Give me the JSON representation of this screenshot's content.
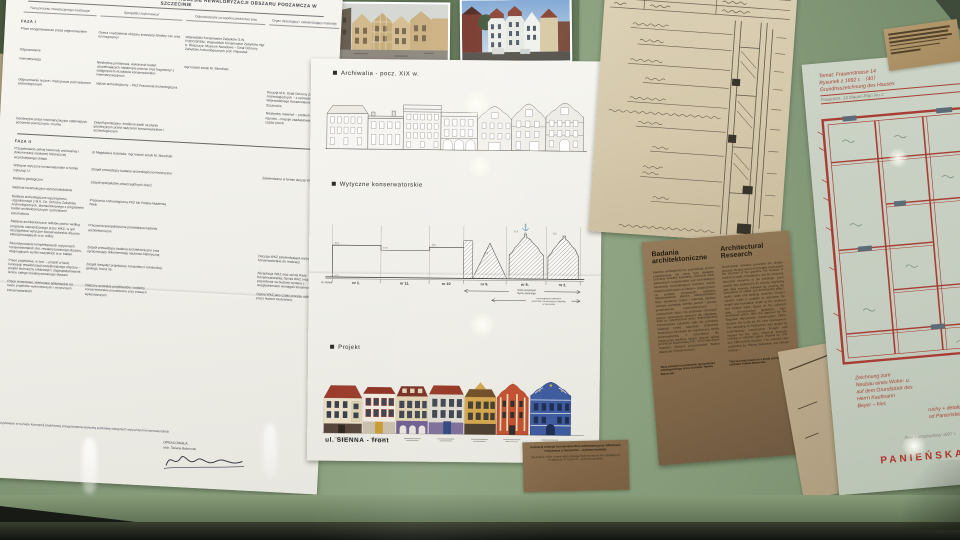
{
  "left_doc": {
    "title": "SCHEMAT POSTĘPOWANIA KONSERWATORSKIEGO W PROCESIE REWALORYZACJI OBSZARU PODZAMCZA W SZCZECINIE",
    "columns": [
      "Faza procesu inwestycyjnego /realizacja/",
      "Specjaliści /wykonawcy/",
      "Odpowiedzialni za współuczestnictwo prac",
      "Organ decydujący i zatwierdzający materiały"
    ],
    "faza1_label": "FAZA I",
    "faza2_label": "FAZA II",
    "faza1_rows": [
      {
        "c1": "Prace przygotowawcze przed odgruzowaniem",
        "c2": "Ocena i wydzielenie obszaru inwestycji /obiekty ruin oraz ich fragmenty/",
        "c3": "Wojewódzki Konserwator Zabytków O.W. PODGÓRSKI; Wojewódzki Konserwator Zabytków mgr K. Błaszczyk; Muzeum Narodowe – Dział Ochrony Zabytków Archeologicznych prof. Filipowiak",
        "c4": ""
      },
      {
        "c1": "Odgruzowanie",
        "c2": "",
        "c3": "",
        "c4": ""
      },
      {
        "c1": "Inwentaryzacja",
        "c2": "Niezbędna pomiarowa, wykonanie badań uzupełniających /odsłonięte piwnice oraz fragmenty/ z osiągnięciem rezultatów konserwatorsko-inwentaryzacyjnych",
        "c3": "mgr historii sztuki M. Słomiński",
        "c4": ""
      },
      {
        "c1": "Odgruzowanie ręczne i maszynowe pod nadzorem archeologicznym",
        "c2": "nadzór archeologiczny – PKZ Pracownia Archeologiczna",
        "c3": "",
        "c4": "Decyzja M.K. Dział Ochrony Zabytków Archeologicznych – z upoważnienia Wojewódzkiego Konserwatora Zabytków w Szczecinie"
      },
      {
        "c1": "",
        "c2": "",
        "c3": "",
        "c4": "Niezbędny materiał: – problem geodezyjny rejonów – mapuje zaadaptowane materiały tych części piwnic"
      },
      {
        "c1": "Geodezyjne prace inwentaryzacyjne odsłoniętych poziomów piwnicznych i murów",
        "c2": "Zespół geodezyjny: kreślenie siatki na planie geodezyjnym przed nadzorem konserwatorskim i archeologicznym",
        "c3": "",
        "c4": ""
      }
    ],
    "faza2_rows": [
      {
        "c1": "Przygotowanie pełnej kwerendy archiwalnej i dokumentacji naukowej historycznej wcześniejszego układu",
        "c2": "dr Magdalena Kozińska; mgr historii sztuki M. Słomiński",
        "c3": "",
        "c4": ""
      },
      {
        "c1": "Wstępne wytyczne konserwatorskie w formie instrukcji 'U'",
        "c2": "Zespół prowadzący badania archeologiczno-historyczne",
        "c3": "",
        "c4": "Zatwierdzane w formie decyzji WKZ"
      },
      {
        "c1": "Badania geologiczne",
        "c2": "Zespół specjalistów poszczególnych branż",
        "c3": "",
        "c4": ""
      },
      {
        "c1": "Badania konstrukcyjno-wytrzymałościowe",
        "c2": "",
        "c3": "",
        "c4": ""
      },
      {
        "c1": "Badania archeologiczne wg programu uzgodnionego z M.K. Dz. Ochrony Zabytków Archeologicznych, skonsultowanego z programem badań architektonicznych i potrzebami konstruktora",
        "c2": "Pracownia Archeologiczna PKZ lub Polska Akademia Nauk",
        "c3": "",
        "c4": ""
      },
      {
        "c1": "Badania architektoniczne reliktów piwnic według programu zatwierdzonego przez WKZ, w tym szczegółowe wytyczne konserwatorskie dla prac zabezpieczających w.w. relikty",
        "c2": "Pracownia specjalistyczna prowadząca badania architektoniczne",
        "c3": "",
        "c4": ""
      },
      {
        "c1": "Skoordynowanie kompleksowych wytycznych konserwatorskich dot. rewaloryzowanego obszaru, obejmujących wyniki wszystkich w.w. badań",
        "c2": "Zespół prowadzący badania architektoniczne oraz opracowujący dokumentację naukowo-historyczną",
        "c3": "",
        "c4": "Decyzja WKZ zatwierdzająca wytyczne konserwatorskie do realizacji"
      },
      {
        "c1": "Prace projektowe, w tym: – projekt w fazie koncepcji rewaloryzacji wcześniejszego obszaru – projekt techniczny urbanistyki i zagospodarowania terenu całego rewaloryzowanego obszaru",
        "c2": "Zespół /zespoły/ projektowe; konsultanci: konstrukcji, geologii, branż itp.",
        "c3": "",
        "c4": "Akceptacja WKZ oraz opinia Rady Konserwatorskiej; Opinia WKZ oraz decyzja pozwolenia na budowę wydana z uwzględnieniem wymagań konserwatorskich"
      },
      {
        "c1": "Prace remontowe, wieńczące adaptacyjne na bazie projektów wykonawczych i wytycznych konserwatorskich",
        "c2": "Nadzory autorskie projektantów i nadzory konserwatorskie prowadzone przy pracach wykonawczych",
        "c3": "",
        "c4": "Opinia WKZ jako część procesu odbioru obiektu przez Nadzór Budowlany"
      }
    ],
    "footer": "Uzyskiwane w tej fazie koncepcji projektowej przygotowania stanowią podstawę wstępnych wytycznych konserwatorskich",
    "author_label": "OPRACOWAŁA:",
    "author_name": "arch. Tatiana Balcerzak"
  },
  "center_doc": {
    "section1": "Archiwalia - pocz. XIX w.",
    "section2": "Wytyczne konserwatorskie",
    "section3": "Projekt",
    "baseline_label": "N. Rynek",
    "datum": "0.00",
    "plots": [
      "nr 1.",
      "nr 11.",
      "nr 10",
      "nr 9.",
      "nr 8.",
      "nr 2."
    ],
    "heights": [
      "21,5",
      "17,0",
      "19,0",
      "17,5",
      "21,0",
      "21,5"
    ],
    "zone1a": "strefa ekspozycji",
    "zone1b": "Rynku Siennego",
    "zone2a": "rozstrzygnięcia wykonane",
    "zone2b": "przez Woj. Konserwatora Zabytków",
    "zone2c": "w Szczecinie",
    "street": "ul. SIENNA - front"
  },
  "research_card": {
    "title_pl": "Badania architektoniczne",
    "title_en": "Architectural Research",
    "body_pl": "Badania architektoniczne poprzedzały proces projektowania. Ich celem było dokładne poznanie struktury kwartałów, położenia ścian piwnicznych, fundamentów oraz zachowanych elementów konstrukcyjnych kamienic. Każdy kwartał analizowano w całości – rozpoczynano od sondaży terenowych, następnie odgruzowywano piwnice, dokumentowano filary, sklepienia, ściany i materiały. Głębsze sondaże pozwalały określić poziom i sposób posadowienia średniowiecznych i nowożytnych ścian. Na podstawie zebranych danych opracowano wytyczne dla odbudowy, które po zatwierdzeniu przez Wojewódzkiego Konserwatora Zabytków stały się podstawą realizacji nowej zabudowy. Odbudowa Podzamcza kierowała się współczesną myślą konserwatorską, z szacunkiem dla historycznej struktury miasta, tworząc spójną przestrzeń inspirowaną XVII- i XVIII-wiecznymi fasadami. Badania przeprowadzili Tatiana Balcerzak i Henryk Kustosz.",
    "body_en": "Architectural research preceded the design process. Its goal was to thoroughly understand the structure of the quarters, the location of basement walls, foundations, and the surviving structural elements of the buildings. Each quarter was analysed in its entirety, beginning with field surveys, followed by clearing the basements of rubble and inventorying pillars, vaults, walls and building materials. Deeper surveys made it possible to determine the height and foundation depth of the medieval and modern walls. Based on the collected data, reconstruction guidelines were developed which, after the approval by the Regional Monuments Conservation Office, became the basis for the new development. The rebuilding of Podzamcze was guided by contemporary conservation thought with respect for the city's historical structure, creating a coherent space inspired by 17th- and 18th-century facades. The research was conducted by Tatiana Balcerzak and Henryk Kustosz.",
    "note_pl": "Tekst powstał na podstawie opracowania udostępnionego przez architekt Tatianę Balcerzak.",
    "note_en": "This text was based on a study provided by architect Tatiana Balcerzak."
  },
  "plan_doc": {
    "h1": "Temat:  Frauenstrasse 14",
    "h2": "Rysunek z 1892 r.                （40）",
    "h3": "Grundrisszeichnung des Hauses",
    "h4": "Frauenstr. 14   Mauer-Plan   No 2",
    "b1": "Zeichnung zum",
    "b2": "Neubau eines Wohn- u.",
    "b3": "auf dem Grundstück des",
    "b4": "Herrn Kaufmann",
    "b5": "Beyer – hier,",
    "m1": "ruchy + detale",
    "m2": "od Panieńskiej",
    "pencil": "Plan z przebudowy 1897 r.",
    "street": "PANIEŃSKA"
  },
  "caption_card": {
    "pl": "Ilustracja strategii konserwatorskiej realizowanej przy odbudowie Podzamcza w Szczecinie – wybrane kwartały.",
    "en": "Illustration of the conservation strategy implemented in the rebuilding of Podzamcze in Szczecin – selected quarters."
  },
  "colors": {
    "table_green": "#8aa07e",
    "red_ink": "#b0423a",
    "kraft": "#83694a"
  }
}
